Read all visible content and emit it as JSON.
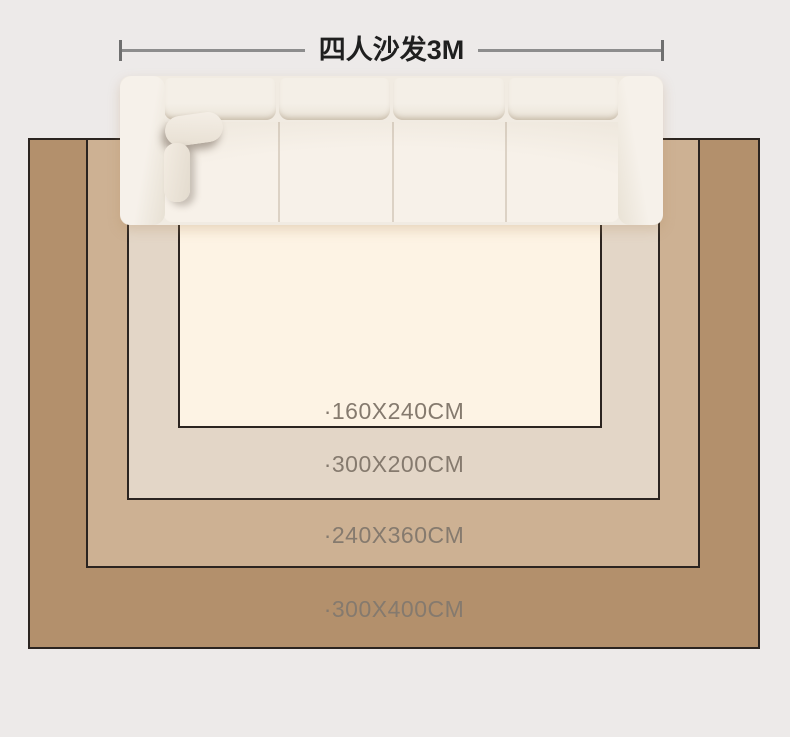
{
  "page": {
    "background": "#edeae9"
  },
  "dimension": {
    "label": "四人沙发3M",
    "line_color": "#8d8d8d",
    "tick_color": "#6f6f6f",
    "text_color": "#1f1f1f"
  },
  "rugs": [
    {
      "label": "·300X400CM",
      "color": "#b3906c"
    },
    {
      "label": "·240X360CM",
      "color": "#cdb193"
    },
    {
      "label": "·300X200CM",
      "color": "#e3d6c7"
    },
    {
      "label": "·160X240CM",
      "color": "#fdf3e4"
    }
  ],
  "rug_border_color": "#2b2420",
  "label_text_color": "#857a6e",
  "sofa": {
    "type": "four-seat-sofa-top-view",
    "seat_count": 4,
    "body_color": "#f1ebe2"
  }
}
